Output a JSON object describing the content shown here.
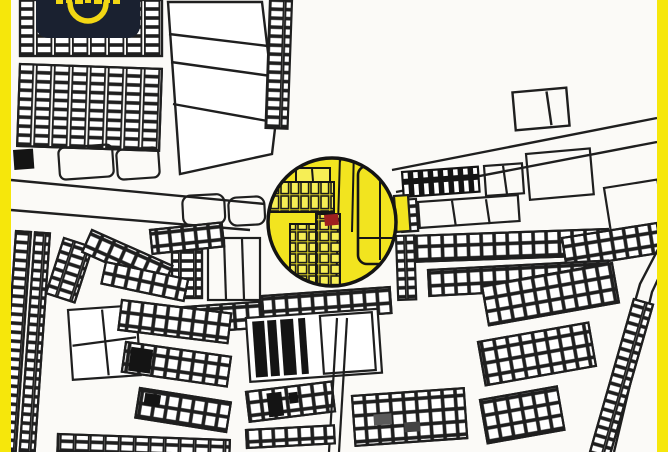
{
  "colors": {
    "frame_yellow": "#F6E70B",
    "map_background": "#FBFAF7",
    "map_line": "#1F1F1F",
    "parcel_fill_black": "#141414",
    "highlight_yellow": "#F2E41F",
    "highlight_cell_yellow": "#F6EE55",
    "highlight_ring": "#141414",
    "marker_red": "#9E2020",
    "badge_navy": "#1A2130",
    "badge_yellow": "#F2D714"
  },
  "frame": {
    "left_bar": true,
    "right_bar": true,
    "bar_width_px": 11
  },
  "brand_badge": {
    "smile_icon": "smile-arc-icon",
    "wordmark_cropped_at_top": true
  },
  "map": {
    "kind": "black-and-white cadastral parcel map",
    "highlight": {
      "shape": "circle",
      "center_x": 332,
      "center_y": 222,
      "radius": 64
    },
    "marker": {
      "x": 324,
      "y": 215,
      "width": 14,
      "height": 11
    }
  }
}
